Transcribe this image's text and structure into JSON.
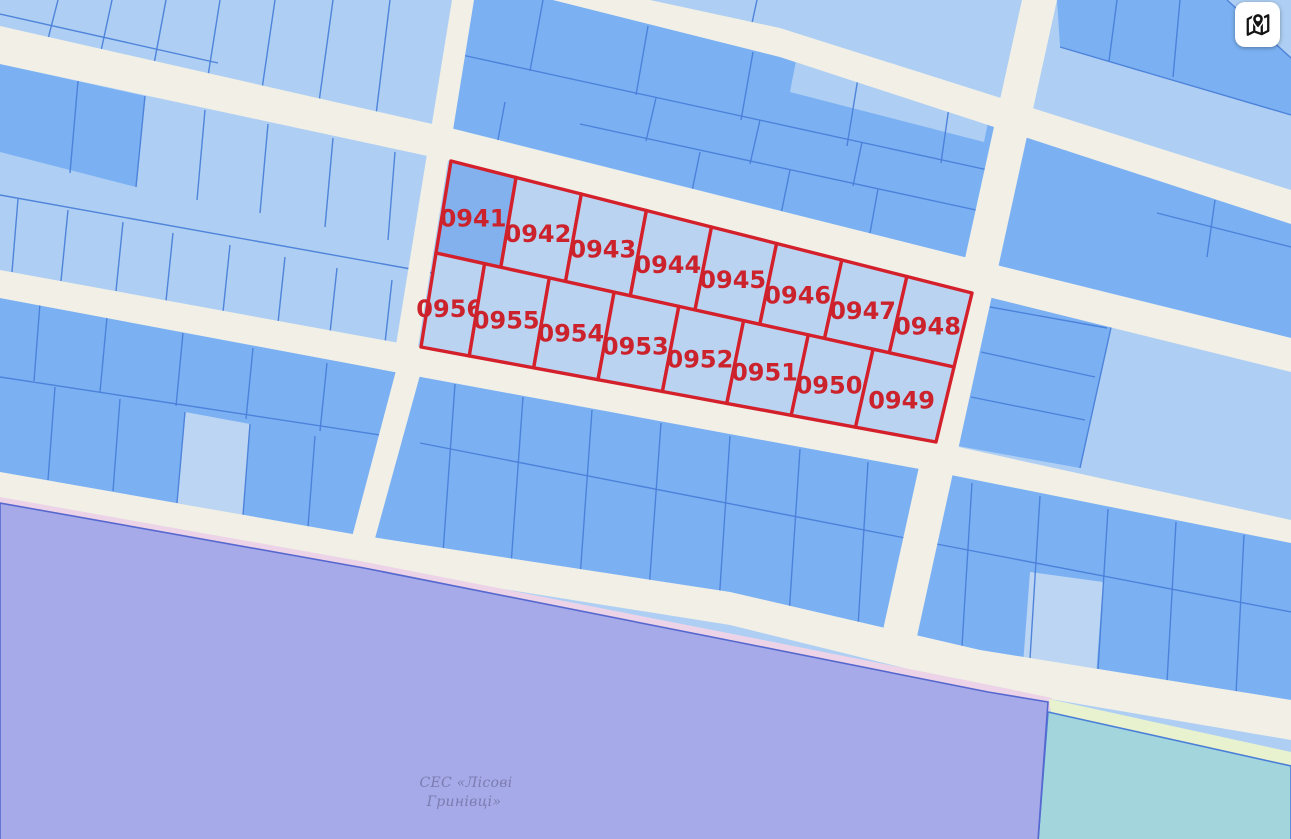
{
  "map": {
    "highlighted_block": {
      "row1": [
        "0941",
        "0942",
        "0943",
        "0944",
        "0945",
        "0946",
        "0947",
        "0948"
      ],
      "row2": [
        "0956",
        "0955",
        "0954",
        "0953",
        "0952",
        "0951",
        "0950",
        "0949"
      ]
    },
    "area_label": {
      "lines": [
        "СЕС «Лісові",
        "Гринівці»"
      ]
    },
    "colors": {
      "highlight_border": "#d4202b",
      "highlight_label": "#cb222c",
      "highlight_fill": "#bad3f1",
      "highlight_fill_selected": "#82b1ee",
      "zone_purple": "#a6aae8",
      "zone_purple_border": "#5668cf",
      "zone_pink": "#ecd3e7",
      "zone_cyan": "#a3d5dd",
      "zone_cyan_border": "#4a7fd8",
      "zone_yellow": "#e9f2cf",
      "road": "#f1efe6",
      "parcel_light": "#aecff3",
      "parcel_medium": "#7bb1f3"
    }
  },
  "controls": {
    "map_style_button": {
      "icon": "map-location-icon"
    }
  }
}
